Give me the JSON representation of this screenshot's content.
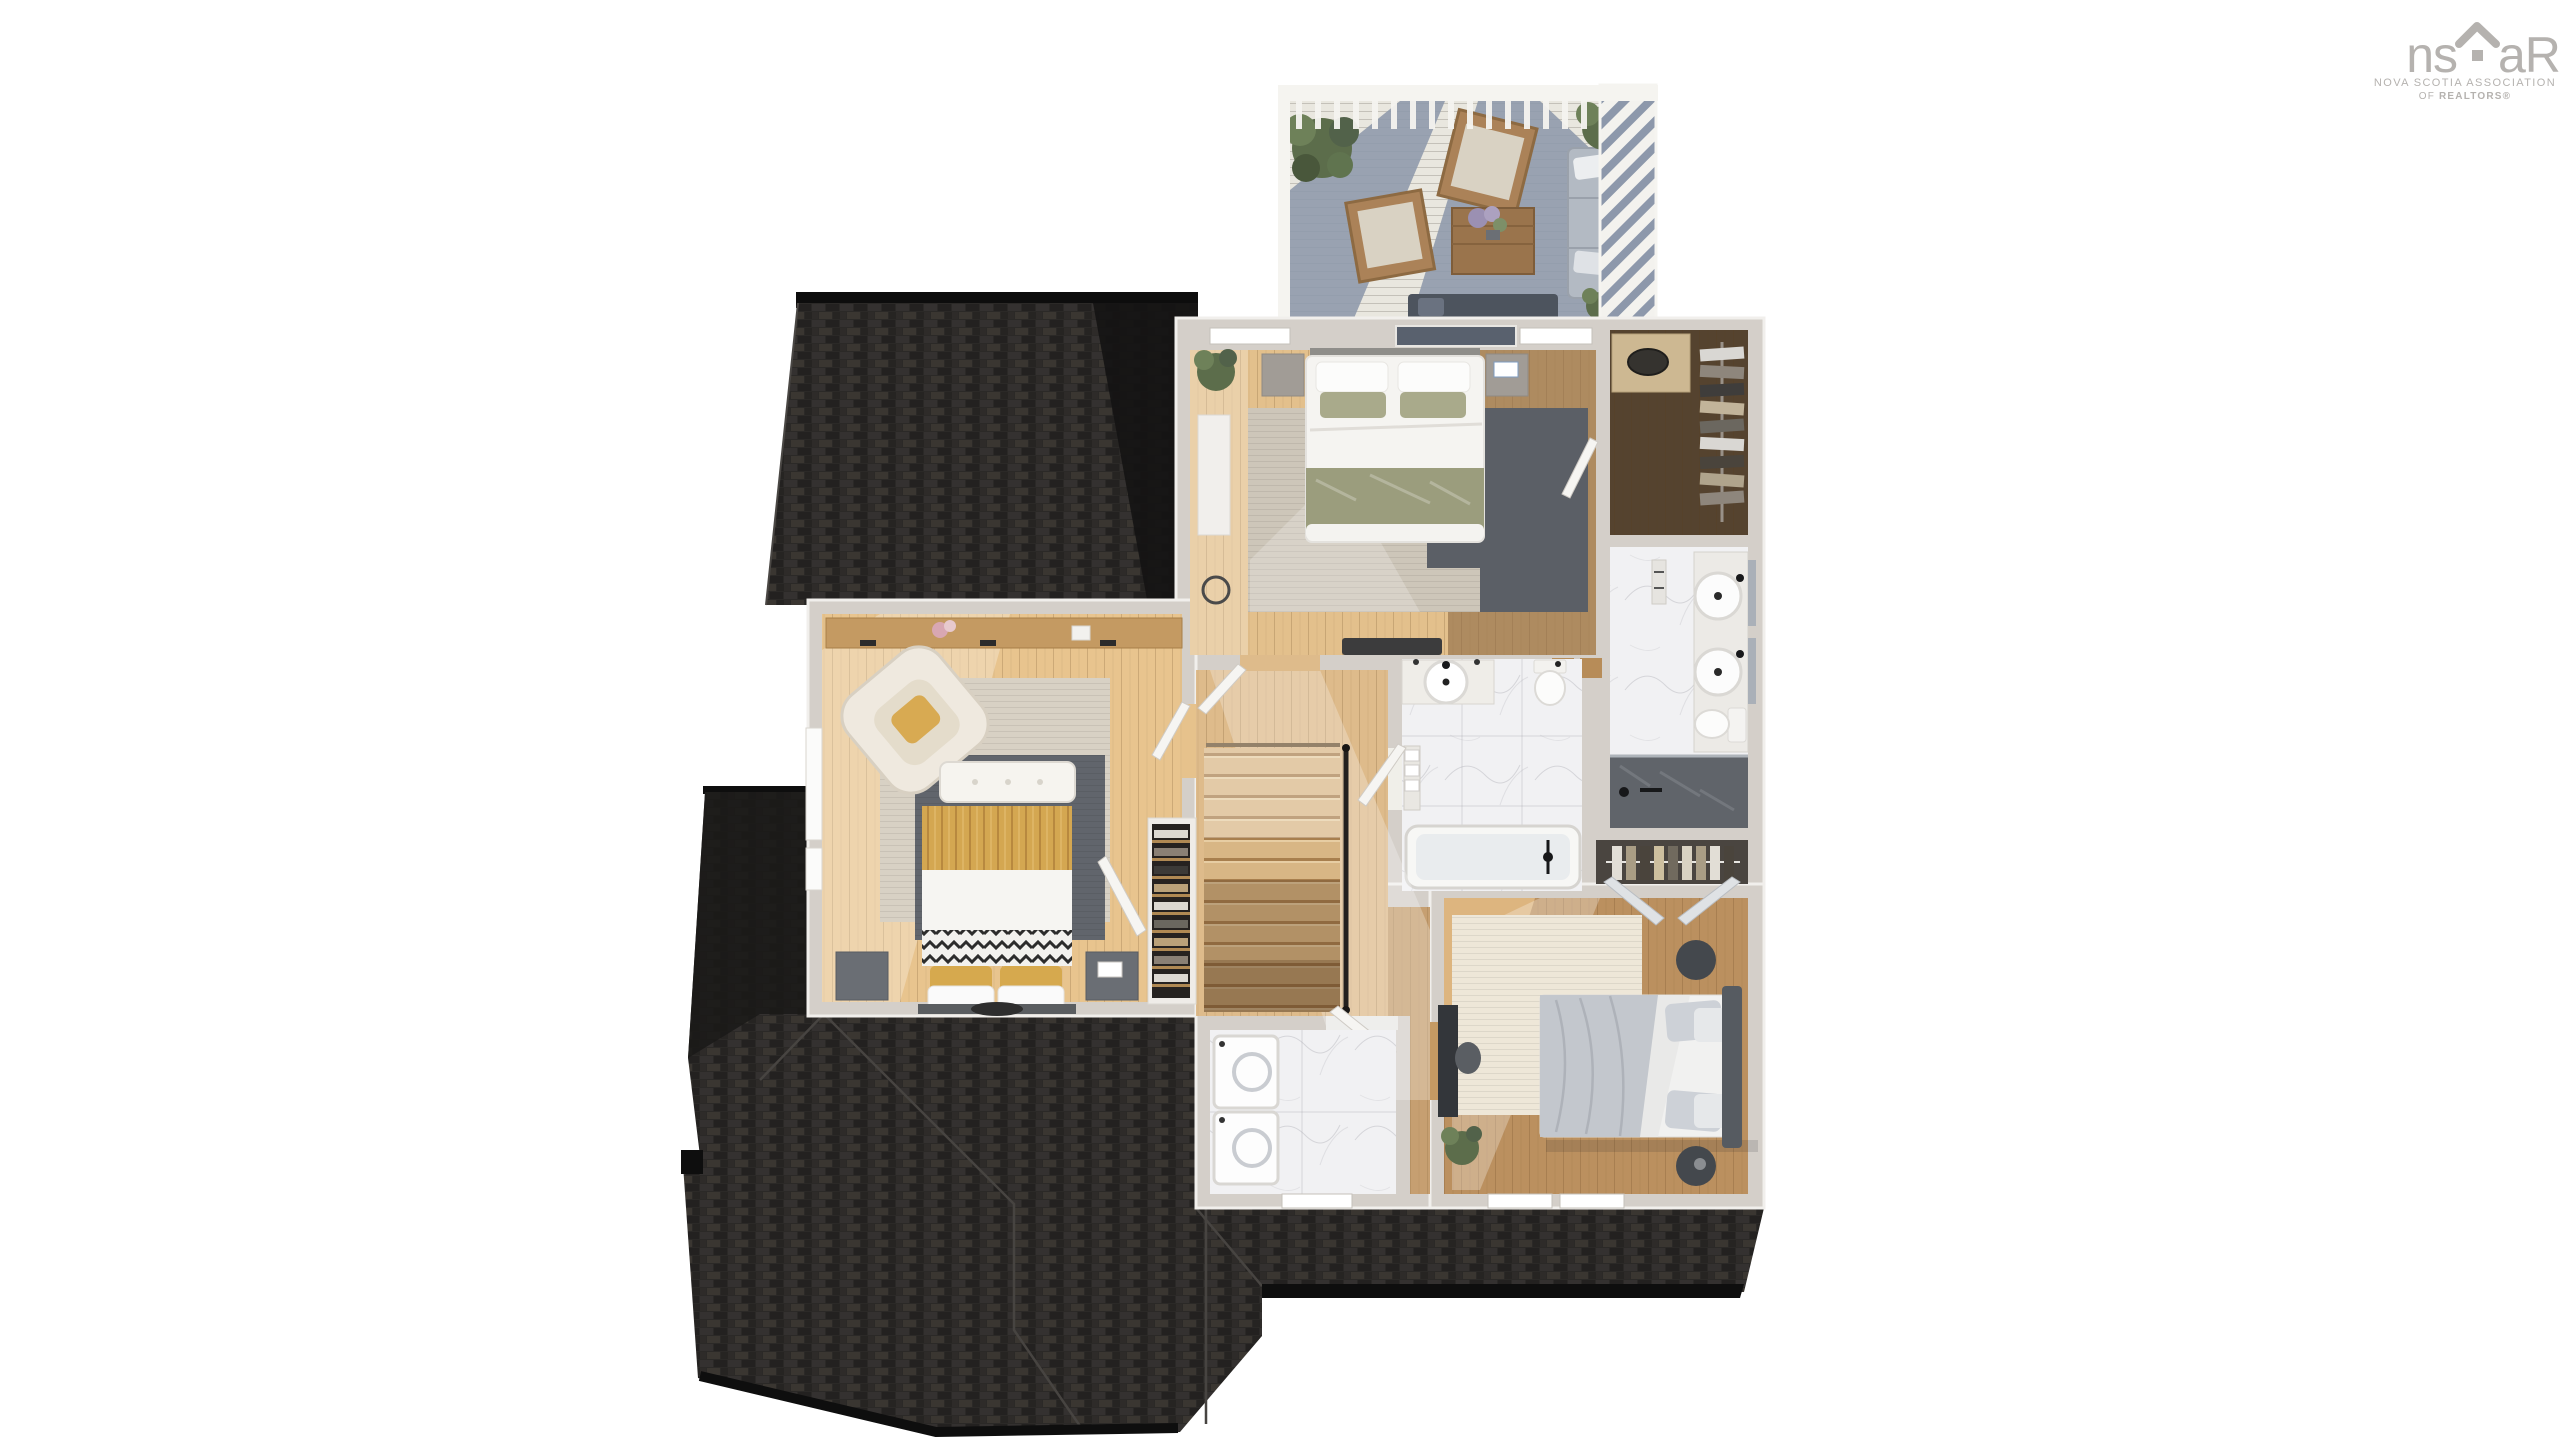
{
  "branding": {
    "logo_text_left": "ns",
    "logo_text_right": "aR",
    "logo_icon": "house-roof-icon",
    "tagline_line1": "NOVA SCOTIA ASSOCIATION",
    "tagline_line2_prefix": "OF ",
    "tagline_line2_bold": "REALTORS®",
    "color": "#b5b2af"
  },
  "scene": {
    "type": "3d-floor-plan-render",
    "view": "top-down dollhouse of upper storey",
    "background": "#ffffff",
    "rooms": [
      {
        "id": "roof-deck",
        "contents": "white pergola, two wood lounge chairs, coffee table with flowers, gray sectional sofa, dark sofa, three potted plants",
        "floor": "light decking with blue-gray pergola shadow"
      },
      {
        "id": "primary-bedroom",
        "contents": "double bed with white and sage-green bedding, two nightstands, bench, plant, white dresser, two-tone rug",
        "floor": "hardwood, light left / dark right"
      },
      {
        "id": "walk-in-closet",
        "contents": "dresser with basket, hanging clothes rack",
        "floor": "dark hardwood"
      },
      {
        "id": "ensuite-bathroom",
        "contents": "double vanity with round vessel sinks, toilet, towel rack, dark marble shower",
        "floor": "white marble"
      },
      {
        "id": "main-bathroom",
        "contents": "vanity with round sink, toilet, bathtub, towel shelf",
        "floor": "white marble"
      },
      {
        "id": "hallway-stairs",
        "contents": "staircase going down with black handrail, linen closet with shelves",
        "floor": "light hardwood"
      },
      {
        "id": "left-bedroom",
        "contents": "bed with mustard striped duvet and chevron throw, tufted bench, cream armchair, console shelf, window, layered rugs, closet with clothes",
        "floor": "light hardwood"
      },
      {
        "id": "laundry-room",
        "contents": "washer and dryer pair, window",
        "floor": "white marble tile"
      },
      {
        "id": "right-bedroom",
        "contents": "bed with gray bedding and dark headboard, two round side tables, desk, plant, cream rug, closet with bifold doors, two windows",
        "floor": "mid-tone hardwood"
      }
    ],
    "palette": {
      "roof_shingle": "#2b2927",
      "roof_shadow": "#151414",
      "ridge_cap": "#0d0d0d",
      "wall": "#d4cfc9",
      "wood_light": "#e3c08c",
      "wood_mid": "#bb905f",
      "wood_dark": "#55432f",
      "marble": "#f1f1f3",
      "shower_dark": "#60646a",
      "deck_shadow": "#8d98ab",
      "rug_beige": "#d5cec1",
      "rug_gray": "#5f636a",
      "bedding_sage": "#9b9d7d",
      "accent_mustard": "#d4a751",
      "bedding_gray": "#c3c7cd",
      "plant_green": "#5c6d4b"
    }
  }
}
